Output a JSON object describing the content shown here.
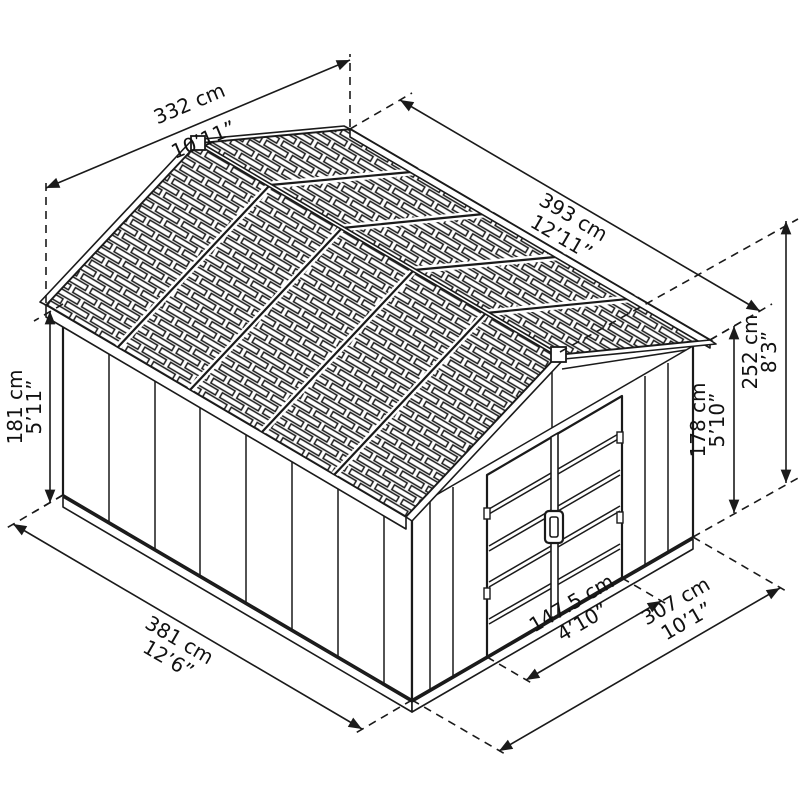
{
  "diagram": {
    "subject": "garden-shed-dimension-drawing"
  },
  "colors": {
    "line": "#1a1a1a",
    "background": "#ffffff"
  },
  "dimensions": {
    "roof_width": {
      "cm": "332 cm",
      "imperial": "10’11”"
    },
    "roof_length": {
      "cm": "393 cm",
      "imperial": "12’11”"
    },
    "total_height": {
      "cm": "252 cm",
      "imperial": "8’3”"
    },
    "front_wall_height": {
      "cm": "178 cm",
      "imperial": "5’10”"
    },
    "side_wall_height": {
      "cm": "181 cm",
      "imperial": "5’11”"
    },
    "side_length": {
      "cm": "381 cm",
      "imperial": "12’6”"
    },
    "door_width": {
      "cm": "147.5 cm",
      "imperial": "4’10”"
    },
    "front_width": {
      "cm": "307 cm",
      "imperial": "10’1”"
    }
  }
}
